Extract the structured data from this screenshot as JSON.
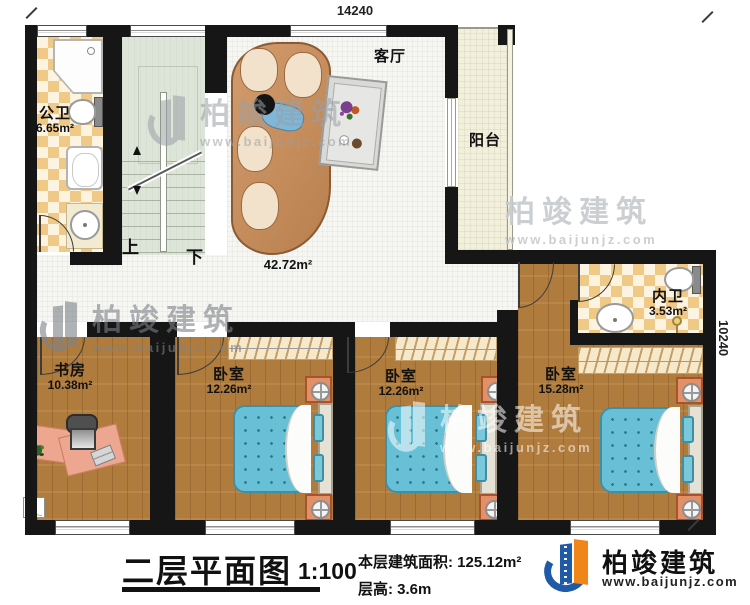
{
  "dimensions": {
    "top": "14240",
    "right": "10240"
  },
  "rooms": {
    "public_bath": {
      "name": "公卫",
      "area": "6.65m²"
    },
    "living": {
      "name": "客厅",
      "area": "42.72m²"
    },
    "balcony": {
      "name": "阳台"
    },
    "inner_bath": {
      "name": "内卫",
      "area": "3.53m²"
    },
    "study": {
      "name": "书房",
      "area": "10.38m²"
    },
    "bedroom1": {
      "name": "卧室",
      "area": "12.26m²"
    },
    "bedroom2": {
      "name": "卧室",
      "area": "12.26m²"
    },
    "bedroom3": {
      "name": "卧室",
      "area": "15.28m²"
    }
  },
  "stairs": {
    "up_label": "上",
    "down_label": "下"
  },
  "footer": {
    "plan_title": "二层平面图",
    "scale": "1:100",
    "area_info": "本层建筑面积: 125.12m²",
    "floor_height": "层高: 3.6m"
  },
  "brand": {
    "name": "柏竣建筑",
    "website": "www.baijunjz.com"
  },
  "watermark": {
    "name": "柏竣建筑",
    "website": "www.baijunjz.com"
  },
  "colors": {
    "wall": "#161616",
    "wood_floor": "#b07c3e",
    "tile_accent": "#f0c987",
    "stair_floor": "#dde4d8",
    "bed": "#67c0d5",
    "brand_blue": "#1e5aa8",
    "brand_orange": "#f08519"
  }
}
